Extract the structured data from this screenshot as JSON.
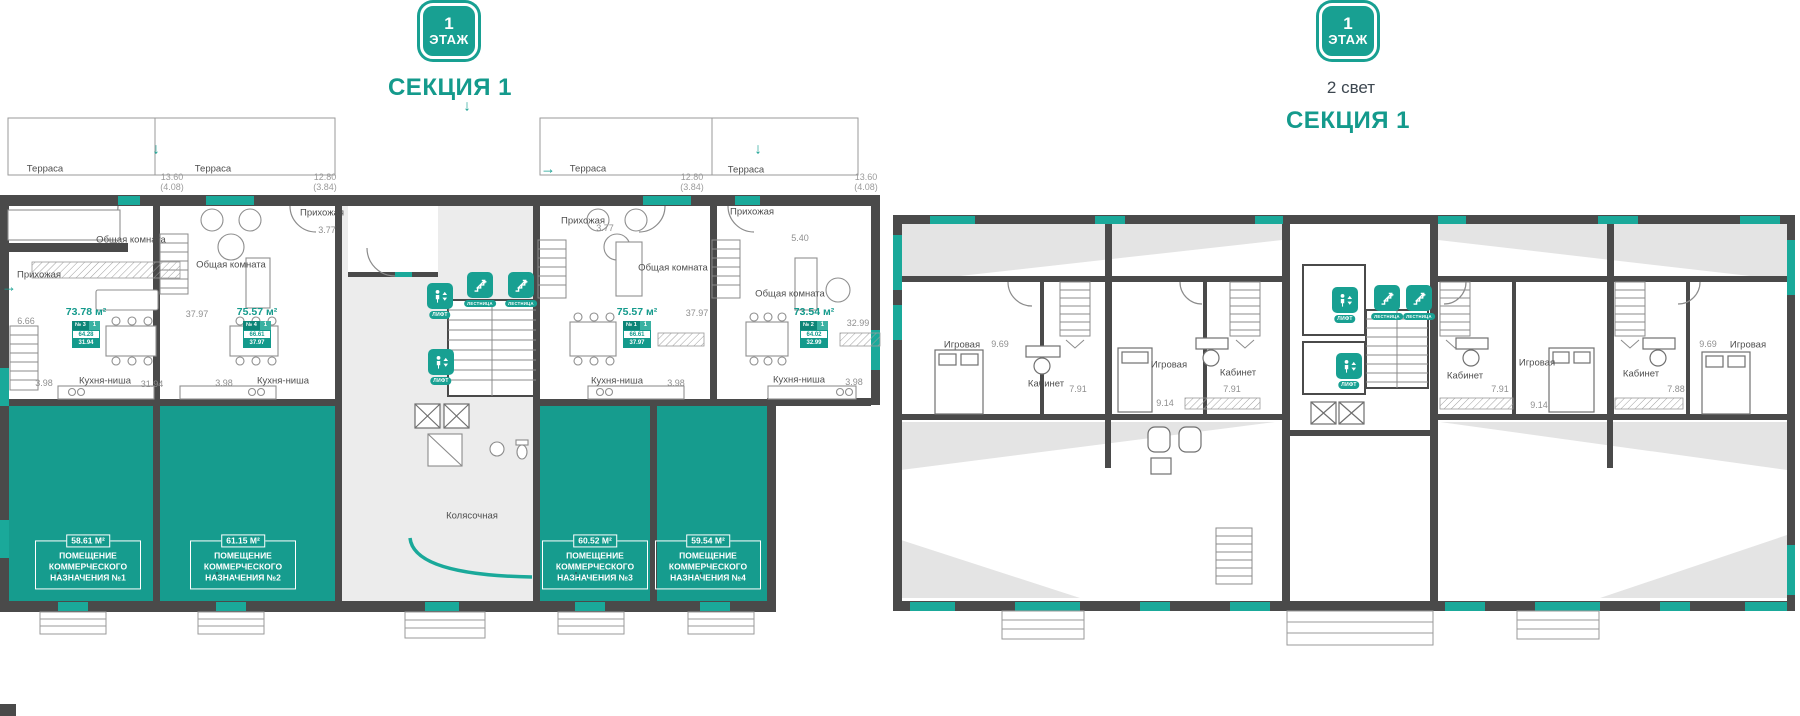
{
  "icons": {
    "arrow_down": "↓",
    "arrow_right": "→",
    "arrow_up": "↑"
  },
  "header_left": {
    "floor": "1",
    "floor_word": "ЭТАЖ",
    "section": "СЕКЦИЯ 1"
  },
  "header_right": {
    "floor": "1",
    "floor_word": "ЭТАЖ",
    "light_note": "2 свет",
    "section": "СЕКЦИЯ 1"
  },
  "labels": {
    "terrace": "Терраса",
    "hall": "Прихожая",
    "living": "Общая комната",
    "kitchen": "Кухня-ниша",
    "stroller": "Колясочная",
    "lift": "лифт",
    "stairs": "лестница"
  },
  "left_plan": {
    "apartments": [
      {
        "num": "№ 3",
        "rooms": "1",
        "total_area": "73.78 м²",
        "inner_area": "64.28",
        "living_area": "31.94",
        "terrace_dim": "13.60",
        "terrace_dim_sub": "(4.08)",
        "hall_area": "6.66",
        "kitchen_area": "3.98",
        "room_area": "31.94"
      },
      {
        "num": "№ 4",
        "rooms": "1",
        "total_area": "75.57 м²",
        "inner_area": "66.61",
        "living_area": "37.97",
        "terrace_dim": "12.80",
        "terrace_dim_sub": "(3.84)",
        "hall_area": "3.77",
        "kitchen_area": "3.98",
        "room_area": "37.97"
      },
      {
        "num": "№ 1",
        "rooms": "1",
        "total_area": "75.57 м²",
        "inner_area": "66.61",
        "living_area": "37.97",
        "terrace_dim": "12.80",
        "terrace_dim_sub": "(3.84)",
        "hall_area": "3.77",
        "kitchen_area": "3.98",
        "room_area": "37.97"
      },
      {
        "num": "№ 2",
        "rooms": "1",
        "total_area": "73.54 м²",
        "inner_area": "64.02",
        "living_area": "32.99",
        "terrace_dim": "13.60",
        "terrace_dim_sub": "(4.08)",
        "hall_area": "5.40",
        "kitchen_area": "3.98",
        "room_area": "32.99"
      }
    ],
    "commercial": [
      {
        "area": "58.61 м²",
        "label": "ПОМЕЩЕНИЕ КОММЕРЧЕСКОГО НАЗНАЧЕНИЯ №1"
      },
      {
        "area": "61.15 м²",
        "label": "ПОМЕЩЕНИЕ КОММЕРЧЕСКОГО НАЗНАЧЕНИЯ №2"
      },
      {
        "area": "60.52 м²",
        "label": "ПОМЕЩЕНИЕ КОММЕРЧЕСКОГО НАЗНАЧЕНИЯ №3"
      },
      {
        "area": "59.54 м²",
        "label": "ПОМЕЩЕНИЕ КОММЕРЧЕСКОГО НАЗНАЧЕНИЯ №4"
      }
    ]
  },
  "right_plan": {
    "rooms": [
      {
        "name": "Игровая",
        "area": "9.69"
      },
      {
        "name": "Кабинет",
        "area": "7.91"
      },
      {
        "name": "Игровая",
        "area": "9.14"
      },
      {
        "name": "Кабинет",
        "area": "7.91"
      },
      {
        "name": "Кабинет",
        "area": "7.91"
      },
      {
        "name": "Игровая",
        "area": "9.14"
      },
      {
        "name": "Кабинет",
        "area": "7.88"
      },
      {
        "name": "Игровая",
        "area": "9.69"
      }
    ]
  }
}
